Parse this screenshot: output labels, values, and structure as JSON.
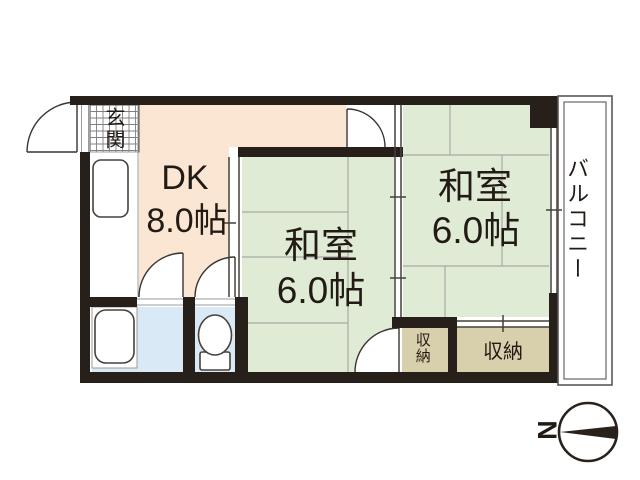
{
  "plan": {
    "rooms": {
      "dk": {
        "name": "DK",
        "size": "8.0帖"
      },
      "washitsu_center": {
        "name": "和室",
        "size": "6.0帖"
      },
      "washitsu_right": {
        "name": "和室",
        "size": "6.0帖"
      },
      "genkan": {
        "name": "玄関"
      },
      "balcony": {
        "name": "バルコニー"
      },
      "storage_small": {
        "name": "収納"
      },
      "storage_large": {
        "name": "収納"
      }
    },
    "compass": {
      "north_label": "N",
      "direction": "left"
    },
    "colors": {
      "wall": "#271f1a",
      "dk_floor": "#fae6d3",
      "tatami_floor": "#e0ebd6",
      "wet_floor": "#d9eaf6",
      "storage_floor": "#d8cfac",
      "tatami_line": "#a8aaa4",
      "balcony_line": "#5a5757",
      "text": "#221b15"
    }
  }
}
